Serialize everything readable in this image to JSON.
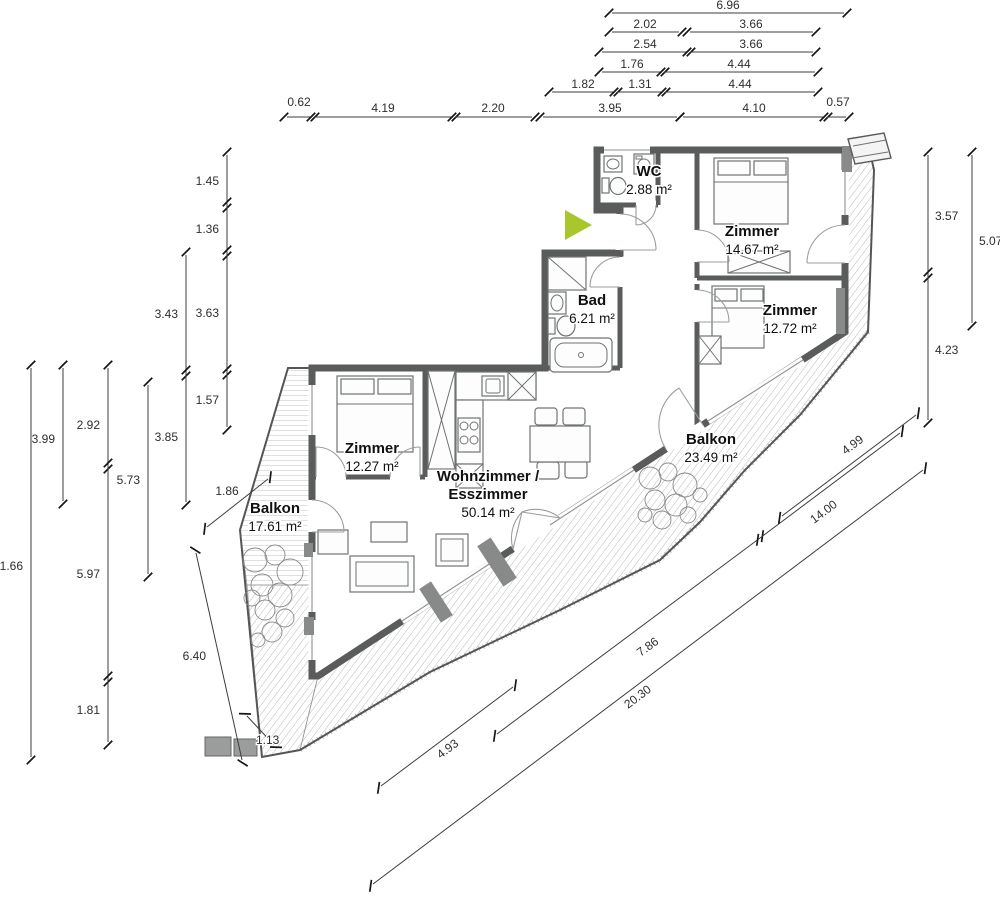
{
  "palette": {
    "wall": "#595c5a",
    "entrance_arrow": "#a9c72d",
    "dimension_text": "#2e2e2e",
    "hatch": "#a8a8a8"
  },
  "rooms": [
    {
      "id": "wc",
      "lines": [
        "WC"
      ],
      "area": "2.88 m²",
      "x": 649,
      "y": 176
    },
    {
      "id": "zimmer-1",
      "lines": [
        "Zimmer"
      ],
      "area": "14.67 m²",
      "x": 752,
      "y": 236
    },
    {
      "id": "zimmer-2",
      "lines": [
        "Zimmer"
      ],
      "area": "12.72 m²",
      "x": 790,
      "y": 315
    },
    {
      "id": "bad",
      "lines": [
        "Bad"
      ],
      "area": "6.21 m²",
      "x": 592,
      "y": 305
    },
    {
      "id": "zimmer-3",
      "lines": [
        "Zimmer"
      ],
      "area": "12.27 m²",
      "x": 372,
      "y": 453
    },
    {
      "id": "wohnzimmer",
      "lines": [
        "Wohnzimmer /",
        "Esszimmer"
      ],
      "area": "50.14 m²",
      "x": 488,
      "y": 481
    },
    {
      "id": "balkon-right",
      "lines": [
        "Balkon"
      ],
      "area": "23.49 m²",
      "x": 711,
      "y": 444
    },
    {
      "id": "balkon-left",
      "lines": [
        "Balkon"
      ],
      "area": "17.61 m²",
      "x": 275,
      "y": 513
    }
  ],
  "dimensions": [
    {
      "v": "6.96",
      "x1": 612,
      "y1": 13,
      "x2": 844,
      "y2": 13,
      "lx": 728,
      "ly": 9
    },
    {
      "v": "2.02",
      "x1": 612,
      "y1": 32,
      "x2": 679,
      "y2": 32,
      "lx": 645,
      "ly": 28
    },
    {
      "v": "3.66",
      "x1": 690,
      "y1": 32,
      "x2": 813,
      "y2": 32,
      "lx": 751,
      "ly": 28
    },
    {
      "v": "2.54",
      "x1": 602,
      "y1": 52,
      "x2": 688,
      "y2": 52,
      "lx": 645,
      "ly": 48
    },
    {
      "v": "3.66",
      "x1": 690,
      "y1": 52,
      "x2": 813,
      "y2": 52,
      "lx": 751,
      "ly": 48
    },
    {
      "v": "1.76",
      "x1": 602,
      "y1": 72,
      "x2": 662,
      "y2": 72,
      "lx": 632,
      "ly": 68
    },
    {
      "v": "4.44",
      "x1": 664,
      "y1": 72,
      "x2": 815,
      "y2": 72,
      "lx": 739,
      "ly": 68
    },
    {
      "v": "1.82",
      "x1": 552,
      "y1": 92,
      "x2": 615,
      "y2": 92,
      "lx": 583,
      "ly": 88
    },
    {
      "v": "1.31",
      "x1": 617,
      "y1": 92,
      "x2": 663,
      "y2": 92,
      "lx": 640,
      "ly": 88
    },
    {
      "v": "4.44",
      "x1": 665,
      "y1": 92,
      "x2": 815,
      "y2": 92,
      "lx": 740,
      "ly": 88
    },
    {
      "v": "0.62",
      "x1": 287,
      "y1": 117,
      "x2": 312,
      "y2": 117,
      "lx": 299,
      "ly": 106
    },
    {
      "v": "4.19",
      "x1": 314,
      "y1": 117,
      "x2": 453,
      "y2": 117,
      "lx": 383,
      "ly": 112
    },
    {
      "v": "2.20",
      "x1": 455,
      "y1": 117,
      "x2": 532,
      "y2": 117,
      "lx": 493,
      "ly": 112
    },
    {
      "v": "3.95",
      "x1": 543,
      "y1": 117,
      "x2": 677,
      "y2": 117,
      "lx": 610,
      "ly": 112
    },
    {
      "v": "4.10",
      "x1": 683,
      "y1": 117,
      "x2": 825,
      "y2": 117,
      "lx": 754,
      "ly": 112
    },
    {
      "v": "0.57",
      "x1": 827,
      "y1": 117,
      "x2": 846,
      "y2": 117,
      "lx": 838,
      "ly": 106
    },
    {
      "v": "1.45",
      "x1": 227,
      "y1": 155,
      "x2": 227,
      "y2": 205,
      "lx": 219,
      "ly": 185,
      "a": "end"
    },
    {
      "v": "1.36",
      "x1": 227,
      "y1": 205,
      "x2": 227,
      "y2": 253,
      "lx": 219,
      "ly": 233,
      "a": "end"
    },
    {
      "v": "3.63",
      "x1": 227,
      "y1": 253,
      "x2": 227,
      "y2": 372,
      "lx": 219,
      "ly": 317,
      "a": "end"
    },
    {
      "v": "1.57",
      "x1": 227,
      "y1": 372,
      "x2": 227,
      "y2": 427,
      "lx": 219,
      "ly": 404,
      "a": "end"
    },
    {
      "v": "3.43",
      "x1": 186,
      "y1": 255,
      "x2": 186,
      "y2": 373,
      "lx": 178,
      "ly": 318,
      "a": "end"
    },
    {
      "v": "3.85",
      "x1": 186,
      "y1": 373,
      "x2": 186,
      "y2": 502,
      "lx": 178,
      "ly": 441,
      "a": "end"
    },
    {
      "v": "5.73",
      "x1": 148,
      "y1": 385,
      "x2": 148,
      "y2": 574,
      "lx": 140,
      "ly": 484,
      "a": "end"
    },
    {
      "v": "2.92",
      "x1": 108,
      "y1": 368,
      "x2": 108,
      "y2": 466,
      "lx": 100,
      "ly": 429,
      "a": "end"
    },
    {
      "v": "5.97",
      "x1": 108,
      "y1": 466,
      "x2": 108,
      "y2": 679,
      "lx": 100,
      "ly": 578,
      "a": "end"
    },
    {
      "v": "1.81",
      "x1": 108,
      "y1": 679,
      "x2": 108,
      "y2": 742,
      "lx": 100,
      "ly": 714,
      "a": "end"
    },
    {
      "v": "3.99",
      "x1": 63,
      "y1": 368,
      "x2": 63,
      "y2": 501,
      "lx": 55,
      "ly": 443,
      "a": "end"
    },
    {
      "v": "11.66",
      "x1": 31,
      "y1": 368,
      "x2": 31,
      "y2": 757,
      "lx": 23,
      "ly": 570,
      "a": "end"
    },
    {
      "v": "3.57",
      "x1": 928,
      "y1": 155,
      "x2": 928,
      "y2": 275,
      "lx": 935,
      "ly": 220,
      "a": "start"
    },
    {
      "v": "4.23",
      "x1": 928,
      "y1": 275,
      "x2": 928,
      "y2": 420,
      "lx": 935,
      "ly": 354,
      "a": "start"
    },
    {
      "v": "5.07",
      "x1": 972,
      "y1": 155,
      "x2": 972,
      "y2": 323,
      "lx": 979,
      "ly": 245,
      "a": "start"
    },
    {
      "v": "4.93",
      "x1": 381,
      "y1": 786,
      "x2": 513,
      "y2": 687,
      "lx": 450,
      "ly": 752,
      "r": -37
    },
    {
      "v": "7.86",
      "x1": 497,
      "y1": 734,
      "x2": 760,
      "y2": 538,
      "lx": 650,
      "ly": 650,
      "r": -36
    },
    {
      "v": "14.00",
      "x1": 760,
      "y1": 538,
      "x2": 900,
      "y2": 433,
      "lx": 826,
      "ly": 515,
      "r": -37
    },
    {
      "v": "20.30",
      "x1": 373,
      "y1": 884,
      "x2": 923,
      "y2": 470,
      "lx": 640,
      "ly": 700,
      "r": -37
    },
    {
      "v": "4.99",
      "x1": 782,
      "y1": 516,
      "x2": 916,
      "y2": 415,
      "lx": 855,
      "ly": 448,
      "r": -37
    },
    {
      "v": "6.40",
      "x1": 196,
      "y1": 553,
      "x2": 242,
      "y2": 760,
      "lx": 206,
      "ly": 660,
      "a": "end"
    },
    {
      "v": "1.13",
      "x1": 247,
      "y1": 716,
      "x2": 274,
      "y2": 745,
      "lx": 256,
      "ly": 744,
      "a": "start"
    },
    {
      "v": "1.86",
      "x1": 207,
      "y1": 527,
      "x2": 268,
      "y2": 479,
      "lx": 227,
      "ly": 495
    }
  ]
}
